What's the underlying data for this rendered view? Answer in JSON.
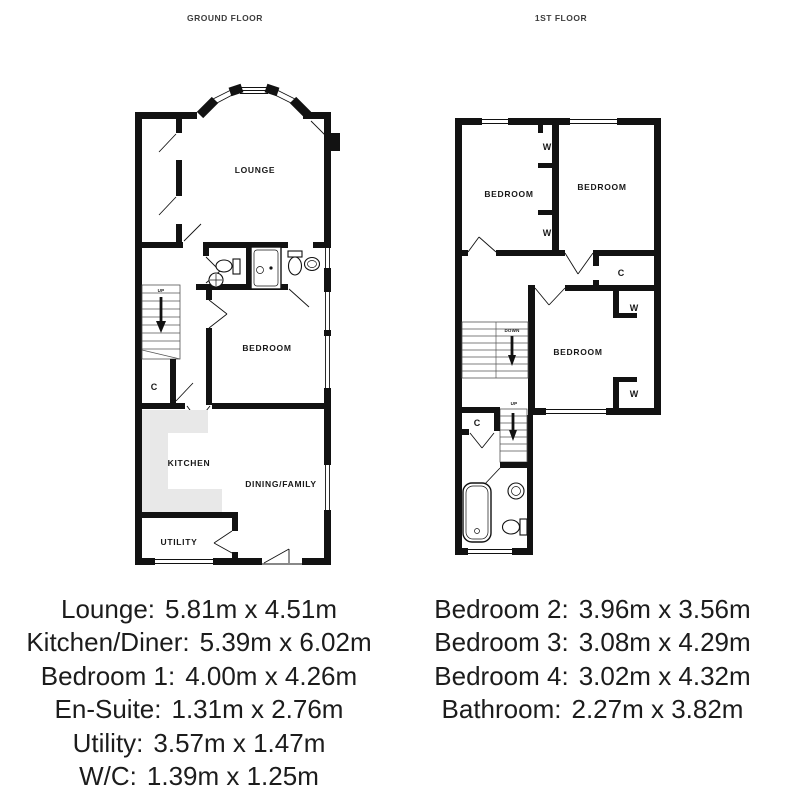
{
  "floors": {
    "ground": {
      "title": "GROUND FLOOR"
    },
    "first": {
      "title": "1ST FLOOR"
    }
  },
  "ground_floor_labels": {
    "lounge": "LOUNGE",
    "bedroom": "BEDROOM",
    "kitchen": "KITCHEN",
    "dining_family": "DINING/FAMILY",
    "utility": "UTILITY",
    "stairs_up": "UP",
    "closet": "C"
  },
  "first_floor_labels": {
    "bedroom_left": "BEDROOM",
    "bedroom_right": "BEDROOM",
    "bedroom_bottom": "BEDROOM",
    "wardrobe": "W",
    "closet": "C",
    "stairs_down": "DOWN",
    "stairs_up": "UP"
  },
  "room_dimensions": {
    "ground": [
      {
        "room": "Lounge:",
        "size": "5.81m x 4.51m"
      },
      {
        "room": "Kitchen/Diner:",
        "size": "5.39m x 6.02m"
      },
      {
        "room": "Bedroom 1:",
        "size": "4.00m x 4.26m"
      },
      {
        "room": "En-Suite:",
        "size": "1.31m x 2.76m"
      },
      {
        "room": "Utility:",
        "size": "3.57m x 1.47m"
      },
      {
        "room": "W/C:",
        "size": "1.39m x 1.25m"
      }
    ],
    "first": [
      {
        "room": "Bedroom 2:",
        "size": "3.96m x 3.56m"
      },
      {
        "room": "Bedroom 3:",
        "size": "3.08m x 4.29m"
      },
      {
        "room": "Bedroom 4:",
        "size": "3.02m x 4.32m"
      },
      {
        "room": "Bathroom:",
        "size": "2.27m x 3.82m"
      }
    ]
  },
  "colors": {
    "wall": "#121212",
    "kitchen_counter": "#e8e8e8",
    "dimension_text": "#1c1c1c",
    "title_text": "#3d3d3d"
  }
}
